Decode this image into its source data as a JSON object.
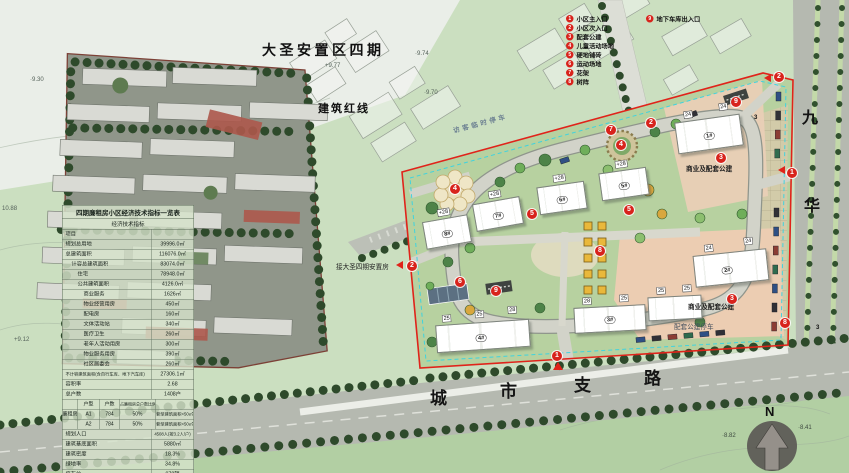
{
  "title": "大圣安置区四期",
  "annotations": {
    "red_line": "建筑红线",
    "visitor_parking": "访客临时停车",
    "connect": "接大圣四期安置房",
    "commercial_top": "商业及配套公建",
    "commercial_bottom": "商业及配套公建",
    "public_parking": "配套公建停车",
    "north": "N"
  },
  "roads": {
    "right": [
      "九",
      "华"
    ],
    "bottom": [
      "城",
      "市",
      "支",
      "路"
    ]
  },
  "elevations": [
    "·9.30",
    "+9.77",
    "·9.74",
    "·9.70",
    "10.88",
    "+9.12",
    "·8.82",
    "·8.41"
  ],
  "legend": {
    "items": [
      {
        "num": "1",
        "label": "小区主入口"
      },
      {
        "num": "2",
        "label": "小区次入口"
      },
      {
        "num": "3",
        "label": "配套公建"
      },
      {
        "num": "4",
        "label": "儿童活动场地"
      },
      {
        "num": "5",
        "label": "硬地铺砖"
      },
      {
        "num": "6",
        "label": "运动场地"
      },
      {
        "num": "7",
        "label": "花架"
      },
      {
        "num": "8",
        "label": "树阵"
      },
      {
        "num": "9",
        "label": "地下车库出入口"
      }
    ]
  },
  "plan_markers": [
    "1",
    "1",
    "2",
    "2",
    "2",
    "3",
    "3",
    "4",
    "4",
    "5",
    "5",
    "6",
    "7",
    "8",
    "8",
    "9",
    "9"
  ],
  "plain_numbers": [
    "3",
    "3"
  ],
  "buildings": [
    {
      "name": "1#",
      "tags": [
        "24",
        "24"
      ]
    },
    {
      "name": "2#",
      "tags": [
        "24",
        "24"
      ]
    },
    {
      "name": "3#",
      "tags": [
        "28",
        "25"
      ]
    },
    {
      "name": "4#",
      "tags": [
        "25",
        "25",
        "28"
      ]
    },
    {
      "name": "5#",
      "tags": [
        "+28"
      ]
    },
    {
      "name": "6#",
      "tags": [
        "+28"
      ]
    },
    {
      "name": "7#",
      "tags": [
        "+28"
      ]
    },
    {
      "name": "8#",
      "tags": [
        "+28"
      ]
    },
    {
      "name": "",
      "tags": [
        "25",
        "25"
      ]
    }
  ],
  "table": {
    "title": "四期廉租房小区经济技术指标一览表",
    "header": "经济技术指标",
    "item_col": "项目",
    "rows": [
      {
        "label": "规划总用地",
        "value": "39996.0㎡"
      },
      {
        "label": "总建筑面积",
        "value": "116076.0㎡"
      },
      {
        "label": "计容总建筑面积",
        "value": "83074.0㎡"
      },
      {
        "label": "住宅",
        "value": "78948.0㎡"
      },
      {
        "label": "公共建筑面积",
        "value": "4126.0㎡"
      },
      {
        "label": "商业服务",
        "value": "1626㎡"
      },
      {
        "label": "物业经营用房",
        "value": "450㎡"
      },
      {
        "label": "配电房",
        "value": "160㎡"
      },
      {
        "label": "文体活动站",
        "value": "340㎡"
      },
      {
        "label": "医疗卫生",
        "value": "260㎡"
      },
      {
        "label": "老年人活动用房",
        "value": "300㎡"
      },
      {
        "label": "物业服务用房",
        "value": "390㎡"
      },
      {
        "label": "社区居委会",
        "value": "260㎡"
      },
      {
        "label": "不计容建筑面积(含自行车库、地下汽车库)",
        "value": "27306.1㎡"
      },
      {
        "label": "容积率",
        "value": "2.68"
      },
      {
        "label": "总户数",
        "value": "1408户"
      }
    ],
    "unit": {
      "group": "廉租房",
      "head": [
        "户型",
        "户数",
        "占廉租房总户数比例",
        ""
      ],
      "rows": [
        [
          "A1",
          "784",
          "50%",
          "套型建筑面积<50㎡"
        ],
        [
          "A2",
          "784",
          "50%",
          "套型建筑面积<50㎡"
        ]
      ]
    },
    "rows2": [
      {
        "label": "规划人口",
        "value": "4508人(按3.2人/户)"
      },
      {
        "label": "建筑基底面积",
        "value": "5880㎡"
      },
      {
        "label": "建筑密度",
        "value": "18.3%"
      },
      {
        "label": "绿地率",
        "value": "34.8%"
      },
      {
        "label": "停车位",
        "value": "978辆"
      },
      {
        "label": "非机动车停车位",
        "value": "2920辆"
      }
    ]
  },
  "colors": {
    "boundary_red": "#e0231a",
    "marker_red": "#d8231c",
    "lawn_green": "#b7d1a0",
    "commercial_pink": "#eccdb2",
    "road_gray": "#b5b9b0"
  }
}
